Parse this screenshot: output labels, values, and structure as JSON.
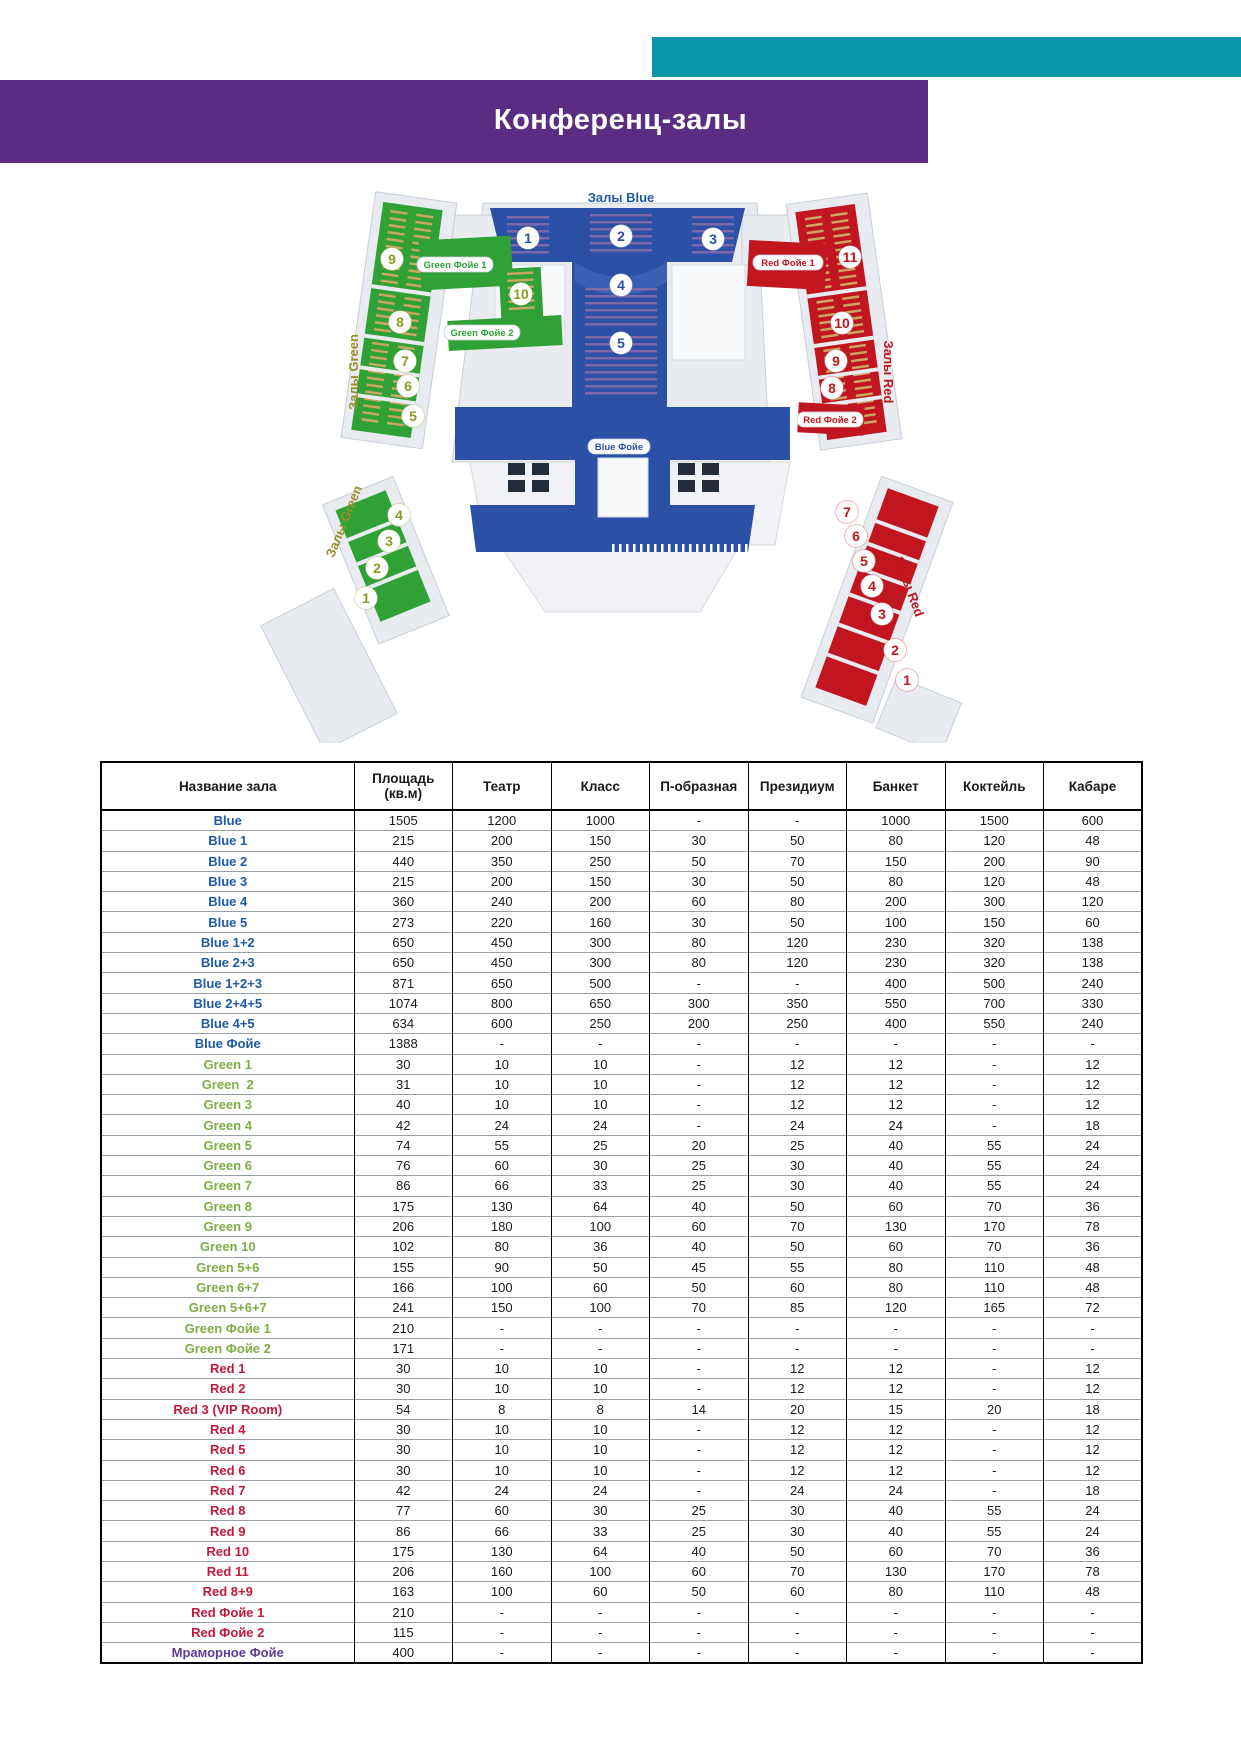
{
  "title": "Конференц-залы",
  "accent_colors": {
    "teal": "#0896AA",
    "purple": "#5A2D82"
  },
  "map": {
    "blue_zone_label": "Залы Blue",
    "green_zone_label": "Залы Green",
    "red_zone_label": "Залы Red",
    "foyer_labels": {
      "green1": "Green Фойе 1",
      "green2": "Green Фойе 2",
      "red1": "Red Фойе 1",
      "red2": "Red Фойе 2",
      "blue": "Blue Фойе"
    },
    "halls": {
      "blue": [
        "1",
        "2",
        "3",
        "4",
        "5"
      ],
      "green_upper": [
        "9",
        "8",
        "7",
        "6",
        "5"
      ],
      "green_extra": [
        "10"
      ],
      "green_lower": [
        "4",
        "3",
        "2",
        "1"
      ],
      "red_upper": [
        "11",
        "10",
        "9",
        "8"
      ],
      "red_lower": [
        "7",
        "6",
        "5",
        "4",
        "3",
        "2",
        "1"
      ]
    },
    "colors": {
      "blue": "#2B50A5",
      "green": "#2FA137",
      "green_number": "#8D9B21",
      "red": "#C1151F"
    }
  },
  "table": {
    "columns": [
      "Название зала",
      "Площадь\n(кв.м)",
      "Театр",
      "Класс",
      "П-образная",
      "Президиум",
      "Банкет",
      "Коктейль",
      "Кабаре"
    ],
    "rows": [
      {
        "name": "Blue",
        "group": "blue",
        "values": [
          "1505",
          "1200",
          "1000",
          "-",
          "-",
          "1000",
          "1500",
          "600"
        ]
      },
      {
        "name": "Blue 1",
        "group": "blue",
        "values": [
          "215",
          "200",
          "150",
          "30",
          "50",
          "80",
          "120",
          "48"
        ]
      },
      {
        "name": "Blue 2",
        "group": "blue",
        "values": [
          "440",
          "350",
          "250",
          "50",
          "70",
          "150",
          "200",
          "90"
        ]
      },
      {
        "name": "Blue 3",
        "group": "blue",
        "values": [
          "215",
          "200",
          "150",
          "30",
          "50",
          "80",
          "120",
          "48"
        ]
      },
      {
        "name": "Blue 4",
        "group": "blue",
        "values": [
          "360",
          "240",
          "200",
          "60",
          "80",
          "200",
          "300",
          "120"
        ]
      },
      {
        "name": "Blue 5",
        "group": "blue",
        "values": [
          "273",
          "220",
          "160",
          "30",
          "50",
          "100",
          "150",
          "60"
        ]
      },
      {
        "name": "Blue 1+2",
        "group": "blue",
        "values": [
          "650",
          "450",
          "300",
          "80",
          "120",
          "230",
          "320",
          "138"
        ]
      },
      {
        "name": "Blue 2+3",
        "group": "blue",
        "values": [
          "650",
          "450",
          "300",
          "80",
          "120",
          "230",
          "320",
          "138"
        ]
      },
      {
        "name": "Blue 1+2+3",
        "group": "blue",
        "values": [
          "871",
          "650",
          "500",
          "-",
          "-",
          "400",
          "500",
          "240"
        ]
      },
      {
        "name": "Blue 2+4+5",
        "group": "blue",
        "values": [
          "1074",
          "800",
          "650",
          "300",
          "350",
          "550",
          "700",
          "330"
        ]
      },
      {
        "name": "Blue 4+5",
        "group": "blue",
        "values": [
          "634",
          "600",
          "250",
          "200",
          "250",
          "400",
          "550",
          "240"
        ]
      },
      {
        "name": "Blue Фойе",
        "group": "blue",
        "values": [
          "1388",
          "-",
          "-",
          "-",
          "-",
          "-",
          "-",
          "-"
        ]
      },
      {
        "name": "Green 1",
        "group": "green",
        "values": [
          "30",
          "10",
          "10",
          "-",
          "12",
          "12",
          "-",
          "12"
        ]
      },
      {
        "name": "Green  2",
        "group": "green",
        "values": [
          "31",
          "10",
          "10",
          "-",
          "12",
          "12",
          "-",
          "12"
        ]
      },
      {
        "name": "Green 3",
        "group": "green",
        "values": [
          "40",
          "10",
          "10",
          "-",
          "12",
          "12",
          "-",
          "12"
        ]
      },
      {
        "name": "Green 4",
        "group": "green",
        "values": [
          "42",
          "24",
          "24",
          "-",
          "24",
          "24",
          "-",
          "18"
        ]
      },
      {
        "name": "Green 5",
        "group": "green",
        "values": [
          "74",
          "55",
          "25",
          "20",
          "25",
          "40",
          "55",
          "24"
        ]
      },
      {
        "name": "Green 6",
        "group": "green",
        "values": [
          "76",
          "60",
          "30",
          "25",
          "30",
          "40",
          "55",
          "24"
        ]
      },
      {
        "name": "Green 7",
        "group": "green",
        "values": [
          "86",
          "66",
          "33",
          "25",
          "30",
          "40",
          "55",
          "24"
        ]
      },
      {
        "name": "Green 8",
        "group": "green",
        "values": [
          "175",
          "130",
          "64",
          "40",
          "50",
          "60",
          "70",
          "36"
        ]
      },
      {
        "name": "Green 9",
        "group": "green",
        "values": [
          "206",
          "180",
          "100",
          "60",
          "70",
          "130",
          "170",
          "78"
        ]
      },
      {
        "name": "Green 10",
        "group": "green",
        "values": [
          "102",
          "80",
          "36",
          "40",
          "50",
          "60",
          "70",
          "36"
        ]
      },
      {
        "name": "Green 5+6",
        "group": "green",
        "values": [
          "155",
          "90",
          "50",
          "45",
          "55",
          "80",
          "110",
          "48"
        ]
      },
      {
        "name": "Green 6+7",
        "group": "green",
        "values": [
          "166",
          "100",
          "60",
          "50",
          "60",
          "80",
          "110",
          "48"
        ]
      },
      {
        "name": "Green 5+6+7",
        "group": "green",
        "values": [
          "241",
          "150",
          "100",
          "70",
          "85",
          "120",
          "165",
          "72"
        ]
      },
      {
        "name": "Green Фойе 1",
        "group": "green",
        "values": [
          "210",
          "-",
          "-",
          "-",
          "-",
          "-",
          "-",
          "-"
        ]
      },
      {
        "name": "Green Фойе 2",
        "group": "green",
        "values": [
          "171",
          "-",
          "-",
          "-",
          "-",
          "-",
          "-",
          "-"
        ]
      },
      {
        "name": "Red 1",
        "group": "red",
        "values": [
          "30",
          "10",
          "10",
          "-",
          "12",
          "12",
          "-",
          "12"
        ]
      },
      {
        "name": "Red 2",
        "group": "red",
        "values": [
          "30",
          "10",
          "10",
          "-",
          "12",
          "12",
          "-",
          "12"
        ]
      },
      {
        "name": "Red 3 (VIP Room)",
        "group": "red",
        "values": [
          "54",
          "8",
          "8",
          "14",
          "20",
          "15",
          "20",
          "18"
        ]
      },
      {
        "name": "Red 4",
        "group": "red",
        "values": [
          "30",
          "10",
          "10",
          "-",
          "12",
          "12",
          "-",
          "12"
        ]
      },
      {
        "name": "Red 5",
        "group": "red",
        "values": [
          "30",
          "10",
          "10",
          "-",
          "12",
          "12",
          "-",
          "12"
        ]
      },
      {
        "name": "Red 6",
        "group": "red",
        "values": [
          "30",
          "10",
          "10",
          "-",
          "12",
          "12",
          "-",
          "12"
        ]
      },
      {
        "name": "Red 7",
        "group": "red",
        "values": [
          "42",
          "24",
          "24",
          "-",
          "24",
          "24",
          "-",
          "18"
        ]
      },
      {
        "name": "Red 8",
        "group": "red",
        "values": [
          "77",
          "60",
          "30",
          "25",
          "30",
          "40",
          "55",
          "24"
        ]
      },
      {
        "name": "Red 9",
        "group": "red",
        "values": [
          "86",
          "66",
          "33",
          "25",
          "30",
          "40",
          "55",
          "24"
        ]
      },
      {
        "name": "Red 10",
        "group": "red",
        "values": [
          "175",
          "130",
          "64",
          "40",
          "50",
          "60",
          "70",
          "36"
        ]
      },
      {
        "name": "Red 11",
        "group": "red",
        "values": [
          "206",
          "160",
          "100",
          "60",
          "70",
          "130",
          "170",
          "78"
        ]
      },
      {
        "name": "Red 8+9",
        "group": "red",
        "values": [
          "163",
          "100",
          "60",
          "50",
          "60",
          "80",
          "110",
          "48"
        ]
      },
      {
        "name": "Red Фойе 1",
        "group": "red",
        "values": [
          "210",
          "-",
          "-",
          "-",
          "-",
          "-",
          "-",
          "-"
        ]
      },
      {
        "name": "Red Фойе 2",
        "group": "red",
        "values": [
          "115",
          "-",
          "-",
          "-",
          "-",
          "-",
          "-",
          "-"
        ]
      },
      {
        "name": "Мраморное Фойе",
        "group": "purple",
        "values": [
          "400",
          "-",
          "-",
          "-",
          "-",
          "-",
          "-",
          "-"
        ]
      }
    ]
  }
}
